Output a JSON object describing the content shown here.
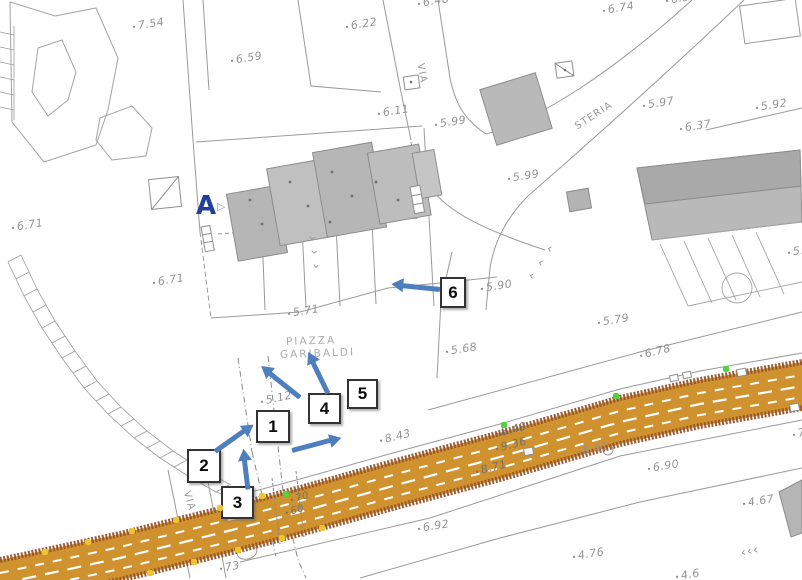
{
  "map": {
    "colors": {
      "road_fill": "#d0922e",
      "road_edge": "#96522a",
      "lane_line": "#ffffff",
      "arrow_blue": "#4d7ebd",
      "marker_a": "#21409d",
      "building_gray": "#b9b9b9",
      "parcel_line": "#9a9a9a",
      "text_gray": "#949494",
      "dot_yellow": "#efc52f",
      "dot_green": "#52d33c"
    },
    "texts": [
      {
        "text": "7.54",
        "x": 133,
        "y": 20,
        "rot": -9,
        "cls": "elev",
        "name": "elevation-label"
      },
      {
        "text": "6.59",
        "x": 231,
        "y": 54,
        "rot": -9,
        "cls": "elev",
        "name": "elevation-label"
      },
      {
        "text": "6.22",
        "x": 346,
        "y": 20,
        "rot": -9,
        "cls": "elev",
        "name": "elevation-label"
      },
      {
        "text": "6.48",
        "x": 418,
        "y": -3,
        "rot": -9,
        "cls": "elev",
        "name": "elevation-label"
      },
      {
        "text": "6.74",
        "x": 603,
        "y": 4,
        "rot": -9,
        "cls": "elev",
        "name": "elevation-label"
      },
      {
        "text": "6.54",
        "x": 666,
        "y": -6,
        "rot": -9,
        "cls": "elev",
        "name": "elevation-label"
      },
      {
        "text": "5.97",
        "x": 643,
        "y": 99,
        "rot": -9,
        "cls": "elev",
        "name": "elevation-label"
      },
      {
        "text": "6.37",
        "x": 680,
        "y": 122,
        "rot": -9,
        "cls": "elev",
        "name": "elevation-label"
      },
      {
        "text": "5.92",
        "x": 756,
        "y": 101,
        "rot": -9,
        "cls": "elev",
        "name": "elevation-label"
      },
      {
        "text": "6.11",
        "x": 378,
        "y": 107,
        "rot": -9,
        "cls": "elev",
        "name": "elevation-label"
      },
      {
        "text": "5.99",
        "x": 435,
        "y": 118,
        "rot": -9,
        "cls": "elev",
        "name": "elevation-label"
      },
      {
        "text": "5.99",
        "x": 508,
        "y": 172,
        "rot": -9,
        "cls": "elev",
        "name": "elevation-label"
      },
      {
        "text": "5.9",
        "x": 788,
        "y": 246,
        "rot": -9,
        "cls": "elev",
        "name": "elevation-label"
      },
      {
        "text": "6.71",
        "x": 12,
        "y": 221,
        "rot": -9,
        "cls": "elev",
        "name": "elevation-label"
      },
      {
        "text": "6.71",
        "x": 153,
        "y": 276,
        "rot": -9,
        "cls": "elev",
        "name": "elevation-label"
      },
      {
        "text": "5.71",
        "x": 288,
        "y": 307,
        "rot": -9,
        "cls": "elev",
        "name": "elevation-label"
      },
      {
        "text": "5.90",
        "x": 481,
        "y": 282,
        "rot": -9,
        "cls": "elev",
        "name": "elevation-label"
      },
      {
        "text": "5.68",
        "x": 446,
        "y": 345,
        "rot": -9,
        "cls": "elev",
        "name": "elevation-label"
      },
      {
        "text": "5.79",
        "x": 598,
        "y": 316,
        "rot": -9,
        "cls": "elev",
        "name": "elevation-label"
      },
      {
        "text": "5.12",
        "x": 261,
        "y": 395,
        "rot": -12,
        "cls": "elev",
        "name": "elevation-label"
      },
      {
        "text": "8.43",
        "x": 380,
        "y": 434,
        "rot": -14,
        "cls": "elev",
        "name": "elevation-label"
      },
      {
        "text": "6.78",
        "x": 640,
        "y": 349,
        "rot": -14,
        "cls": "elev",
        "name": "elevation-label"
      },
      {
        "text": "8.41",
        "x": 578,
        "y": 445,
        "rot": -10,
        "cls": "elev",
        "name": "elevation-label"
      },
      {
        "text": "6.90",
        "x": 648,
        "y": 462,
        "rot": -9,
        "cls": "elev",
        "name": "elevation-label"
      },
      {
        "text": "6.92",
        "x": 418,
        "y": 522,
        "rot": -9,
        "cls": "elev",
        "name": "elevation-label"
      },
      {
        "text": "4.76",
        "x": 573,
        "y": 550,
        "rot": -9,
        "cls": "elev",
        "name": "elevation-label"
      },
      {
        "text": "4.67",
        "x": 743,
        "y": 497,
        "rot": -9,
        "cls": "elev",
        "name": "elevation-label"
      },
      {
        "text": "73",
        "x": 220,
        "y": 562,
        "rot": -10,
        "cls": "elev",
        "name": "elevation-label"
      },
      {
        "text": "7",
        "x": 793,
        "y": 428,
        "rot": -12,
        "cls": "elev",
        "name": "elevation-label"
      },
      {
        "text": "4.6",
        "x": 676,
        "y": 570,
        "rot": -9,
        "cls": "elev",
        "name": "elevation-label"
      },
      {
        "text": "8.43",
        "x": 496,
        "y": 427,
        "rot": -14,
        "cls": "onroad",
        "name": "road-elevation-label"
      },
      {
        "text": "9.36",
        "x": 496,
        "y": 442,
        "rot": -14,
        "cls": "onroad",
        "name": "road-elevation-label"
      },
      {
        "text": "8.71",
        "x": 476,
        "y": 465,
        "rot": -14,
        "cls": "onroad",
        "name": "road-elevation-label"
      },
      {
        "text": "70",
        "x": 291,
        "y": 495,
        "rot": -16,
        "cls": "onroad frag",
        "name": "road-elevation-label"
      },
      {
        "text": "60",
        "x": 286,
        "y": 508,
        "rot": -16,
        "cls": "onroad frag",
        "name": "road-elevation-label"
      },
      {
        "text": "VIA",
        "x": 420,
        "y": 58,
        "rot": 80,
        "cls": "street",
        "name": "street-label-via"
      },
      {
        "text": "STERIA",
        "x": 576,
        "y": 122,
        "rot": -33,
        "cls": "street",
        "name": "street-label-steria"
      },
      {
        "text": "VIA",
        "x": 186,
        "y": 486,
        "rot": 73,
        "cls": "street",
        "name": "street-label-via"
      },
      {
        "text": "PIAZZA",
        "x": 286,
        "y": 336,
        "rot": -2,
        "cls": "place",
        "name": "place-label-piazza"
      },
      {
        "text": "GARIBALDI",
        "x": 280,
        "y": 349,
        "rot": -2,
        "cls": "place",
        "name": "place-label-garibaldi"
      },
      {
        "text": "A",
        "x": 196,
        "y": 191,
        "rot": 0,
        "cls": "marker-a",
        "name": "section-marker-a"
      },
      {
        "text": "▷",
        "x": 217,
        "y": 200,
        "rot": 0,
        "cls": "marker-tri",
        "name": "section-marker-triangle-icon"
      },
      {
        "text": "›",
        "x": 312,
        "y": 228,
        "rot": 95,
        "cls": "chev",
        "name": "chevron-road-marking"
      },
      {
        "text": "›",
        "x": 314,
        "y": 242,
        "rot": 95,
        "cls": "chev",
        "name": "chevron-road-marking"
      },
      {
        "text": "›",
        "x": 316,
        "y": 256,
        "rot": 95,
        "cls": "chev",
        "name": "chevron-road-marking"
      },
      {
        "text": "‹",
        "x": 547,
        "y": 241,
        "rot": 15,
        "cls": "chev",
        "name": "chevron-road-marking"
      },
      {
        "text": "‹",
        "x": 538,
        "y": 255,
        "rot": 15,
        "cls": "chev",
        "name": "chevron-road-marking"
      },
      {
        "text": "‹",
        "x": 529,
        "y": 268,
        "rot": 15,
        "cls": "chev",
        "name": "chevron-road-marking"
      },
      {
        "text": "‹‹‹",
        "x": 741,
        "y": 546,
        "rot": -12,
        "cls": "chev",
        "name": "chevron-road-marking"
      }
    ],
    "numbered_labels": [
      {
        "n": "1",
        "x": 256,
        "y": 410,
        "w": 34,
        "h": 33
      },
      {
        "n": "2",
        "x": 187,
        "y": 449,
        "w": 34,
        "h": 34
      },
      {
        "n": "3",
        "x": 221,
        "y": 486,
        "w": 33,
        "h": 33
      },
      {
        "n": "4",
        "x": 308,
        "y": 393,
        "w": 33,
        "h": 31
      },
      {
        "n": "5",
        "x": 347,
        "y": 379,
        "w": 31,
        "h": 30
      },
      {
        "n": "6",
        "x": 440,
        "y": 277,
        "w": 26,
        "h": 31
      }
    ],
    "arrows": [
      {
        "x1": 300,
        "y1": 397,
        "x2": 261,
        "y2": 366
      },
      {
        "x1": 328,
        "y1": 393,
        "x2": 308,
        "y2": 352
      },
      {
        "x1": 215,
        "y1": 451,
        "x2": 253,
        "y2": 424
      },
      {
        "x1": 248,
        "y1": 489,
        "x2": 243,
        "y2": 448
      },
      {
        "x1": 292,
        "y1": 450,
        "x2": 341,
        "y2": 437
      },
      {
        "x1": 440,
        "y1": 289,
        "x2": 391,
        "y2": 284
      }
    ],
    "dots_yellow": [
      [
        45,
        552
      ],
      [
        88,
        542
      ],
      [
        132,
        531
      ],
      [
        176,
        520
      ],
      [
        220,
        508
      ],
      [
        262,
        496
      ],
      [
        150,
        573
      ],
      [
        194,
        562
      ],
      [
        238,
        550
      ],
      [
        282,
        538
      ],
      [
        322,
        528
      ]
    ],
    "dots_green": [
      [
        286,
        494
      ],
      [
        504,
        425
      ],
      [
        616,
        396
      ],
      [
        726,
        369
      ]
    ]
  }
}
